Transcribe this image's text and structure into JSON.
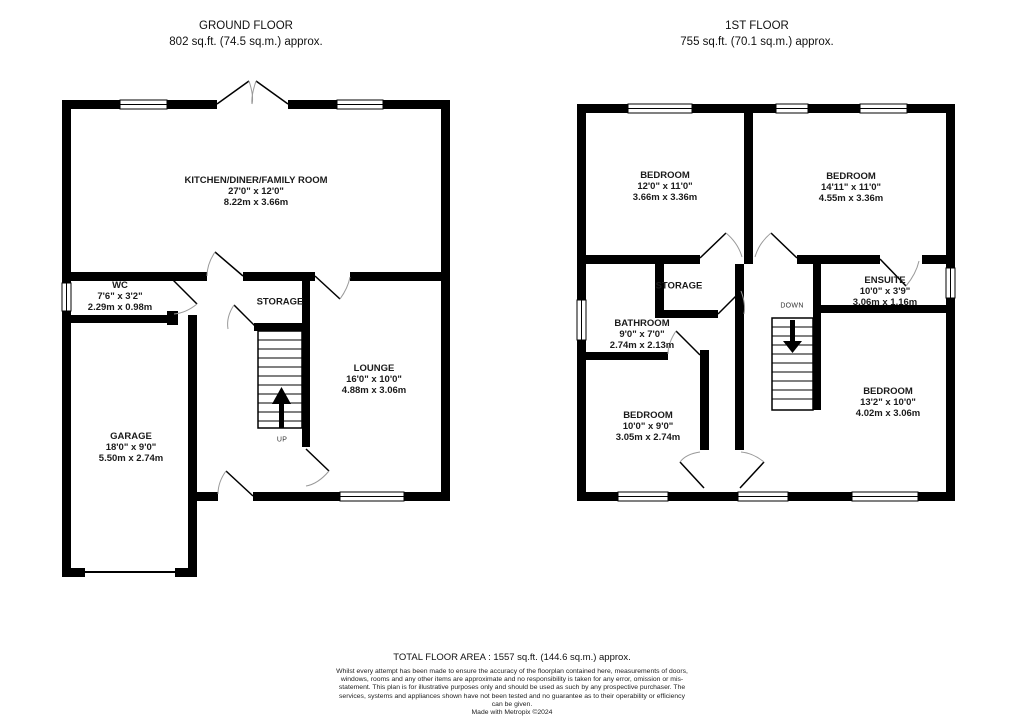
{
  "floors": [
    {
      "title": "GROUND FLOOR",
      "area": "802 sq.ft. (74.5 sq.m.) approx.",
      "stair_label": "UP",
      "rooms": [
        {
          "name": "KITCHEN/DINER/FAMILY ROOM",
          "dim_ft": "27'0\" x 12'0\"",
          "dim_m": "8.22m x 3.66m"
        },
        {
          "name": "WC",
          "dim_ft": "7'6\" x 3'2\"",
          "dim_m": "2.29m x 0.98m"
        },
        {
          "name": "STORAGE"
        },
        {
          "name": "LOUNGE",
          "dim_ft": "16'0\" x 10'0\"",
          "dim_m": "4.88m x 3.06m"
        },
        {
          "name": "GARAGE",
          "dim_ft": "18'0\" x 9'0\"",
          "dim_m": "5.50m x 2.74m"
        }
      ]
    },
    {
      "title": "1ST FLOOR",
      "area": "755 sq.ft. (70.1 sq.m.) approx.",
      "stair_label": "DOWN",
      "rooms": [
        {
          "name": "BEDROOM",
          "dim_ft": "12'0\" x 11'0\"",
          "dim_m": "3.66m x 3.36m"
        },
        {
          "name": "BEDROOM",
          "dim_ft": "14'11\" x 11'0\"",
          "dim_m": "4.55m x 3.36m"
        },
        {
          "name": "STORAGE"
        },
        {
          "name": "ENSUITE",
          "dim_ft": "10'0\" x 3'9\"",
          "dim_m": "3.06m x 1.16m"
        },
        {
          "name": "BATHROOM",
          "dim_ft": "9'0\" x 7'0\"",
          "dim_m": "2.74m x 2.13m"
        },
        {
          "name": "BEDROOM",
          "dim_ft": "10'0\" x 9'0\"",
          "dim_m": "3.05m x 2.74m"
        },
        {
          "name": "BEDROOM",
          "dim_ft": "13'2\" x 10'0\"",
          "dim_m": "4.02m x 3.06m"
        }
      ]
    }
  ],
  "footer": {
    "total": "TOTAL FLOOR AREA : 1557 sq.ft. (144.6 sq.m.) approx.",
    "disclaimer": "Whilst every attempt has been made to ensure the accuracy of the floorplan contained here, measurements of doors, windows, rooms and any other items are approximate and no responsibility is taken for any error, omission or mis-statement. This plan is for illustrative purposes only and should be used as such by any prospective purchaser. The services, systems and appliances shown have not been tested and no guarantee as to their operability or efficiency can be given.",
    "credit": "Made with Metropix ©2024"
  },
  "colors": {
    "wall": "#000000",
    "background": "#ffffff",
    "door_arc": "#999999"
  }
}
